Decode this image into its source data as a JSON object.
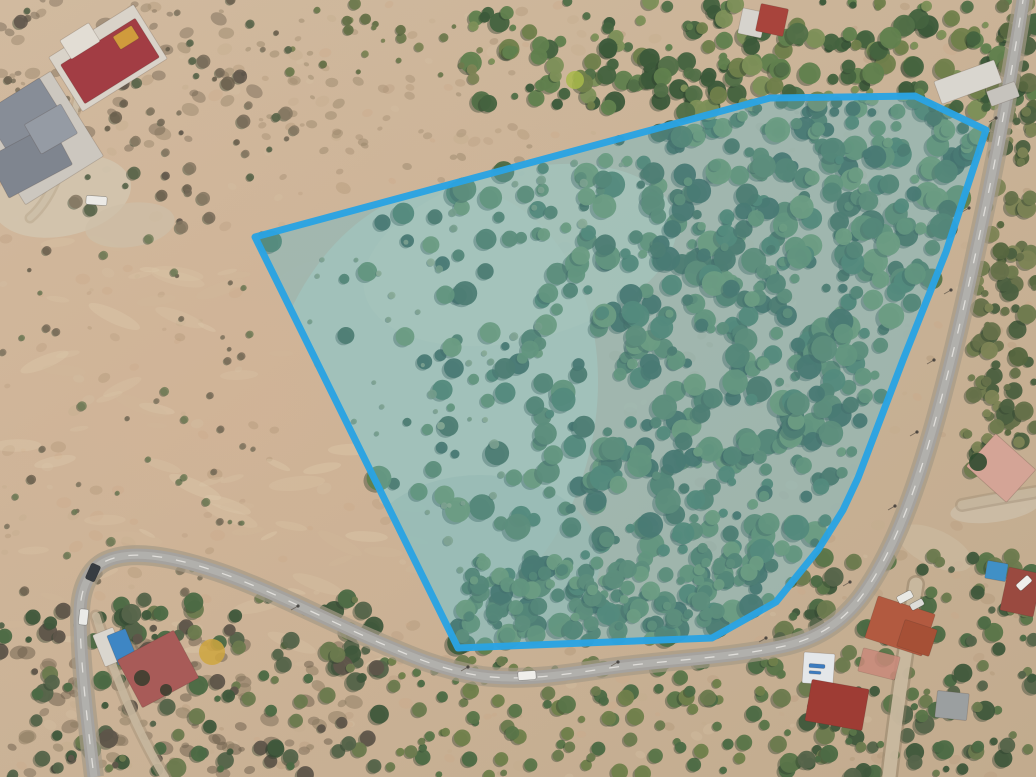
{
  "meta": {
    "image_type": "drone-aerial-orthophoto",
    "alt": "Aerial drone photo of a wooded land parcel outlined with a blue boundary, dry scrubland to the west, a paved road wrapping the south and east sides, and scattered houses"
  },
  "canvas": {
    "width": 1036,
    "height": 777
  },
  "scene": {
    "base_light": "#d1ba9f",
    "base_dark": "#c2ab8e",
    "pink_tint": "#d8b294",
    "tree_shadow": "#2c3f2e"
  },
  "parcel": {
    "name": "highlighted-land-parcel",
    "points": [
      [
        255,
        237
      ],
      [
        770,
        98
      ],
      [
        915,
        96
      ],
      [
        986,
        130
      ],
      [
        946,
        252
      ],
      [
        903,
        360
      ],
      [
        858,
        478
      ],
      [
        843,
        510
      ],
      [
        818,
        550
      ],
      [
        776,
        602
      ],
      [
        712,
        638
      ],
      [
        458,
        648
      ]
    ],
    "fill": "rgba(105,195,230,0.33)",
    "stroke": "#2aa3e2",
    "stroke_width": 7,
    "base_fill": "#a8b08e",
    "base_opacity": 0.45
  },
  "meadows": [
    {
      "name": "parcel-meadow-main",
      "cx": 430,
      "cy": 410,
      "rx": 165,
      "ry": 225,
      "rot": 12,
      "fill": "#bcc2a6",
      "opacity": 0.9
    },
    {
      "name": "parcel-meadow-upper",
      "cx": 520,
      "cy": 255,
      "rx": 160,
      "ry": 85,
      "rot": -14,
      "fill": "#c0c4a6",
      "opacity": 0.8
    },
    {
      "name": "parcel-meadow-lower",
      "cx": 480,
      "cy": 560,
      "rx": 120,
      "ry": 85,
      "rot": 0,
      "fill": "#aeb89c",
      "opacity": 0.7
    }
  ],
  "road": {
    "name": "paved-road",
    "path": "M 1024,-6 C 1014,58 1000,140 984,214 C 968,290 950,372 928,446 C 910,506 890,556 864,593 C 842,624 814,640 780,647 C 722,659 662,660 602,669 C 562,675 522,681 482,676 C 442,670 410,656 371,639 C 321,617 262,586 212,570 C 172,557 132,549 106,561 C 89,569 80,589 80,614 C 80,659 87,719 94,777",
    "casing": "#a59a86",
    "surface": "#a5a29e",
    "wear": "#c2c0bc",
    "line": "#eceae6",
    "width": 13
  },
  "dirt_roads": [
    {
      "name": "dirt-road-southeast",
      "path": "M 916,584 C 907,642 897,706 889,777",
      "stroke": "#c9b9a0",
      "edge": "#8a7a62",
      "width": 13,
      "opacity": 0.95
    },
    {
      "name": "trail-northwest",
      "path": "M 30,218 C 56,196 68,150 76,106 C 80,81 90,62 103,52",
      "stroke": "#cfc1aa",
      "edge": "#b3a188",
      "width": 6,
      "opacity": 0.85
    },
    {
      "name": "driveway-southwest",
      "path": "M 96,616 C 108,654 124,699 142,735 C 151,753 158,766 165,777",
      "stroke": "#c6b79e",
      "edge": "#a08f76",
      "width": 8,
      "opacity": 0.9
    },
    {
      "name": "driveway-east",
      "path": "M 962,505 C 988,500 1012,496 1036,492",
      "stroke": "#c6b79e",
      "edge": "#a08f76",
      "width": 9,
      "opacity": 0.9
    }
  ],
  "dirt_areas": [
    {
      "name": "clearing-northwest-driveway",
      "cx": 62,
      "cy": 196,
      "rx": 70,
      "ry": 40,
      "rot": -12,
      "fill": "#d2c4ae",
      "opacity": 0.9
    },
    {
      "name": "clearing-northwest-2",
      "cx": 130,
      "cy": 225,
      "rx": 45,
      "ry": 22,
      "rot": -8,
      "fill": "#cdbfa8",
      "opacity": 0.7
    },
    {
      "name": "dirt-patch-east-house",
      "cx": 995,
      "cy": 508,
      "rx": 45,
      "ry": 14,
      "rot": -8,
      "fill": "#cbbda6",
      "opacity": 0.9
    },
    {
      "name": "dirt-patch-southeast",
      "cx": 935,
      "cy": 548,
      "rx": 40,
      "ry": 18,
      "rot": 25,
      "fill": "#c9b89e",
      "opacity": 0.8
    }
  ],
  "speckle_zones": [
    {
      "name": "dry-brush-global",
      "rect": [
        0,
        0,
        1036,
        777
      ],
      "count": 430,
      "rmin": 2,
      "rmax": 7,
      "colors": [
        "#b89c7e",
        "#c4ab8d",
        "#ad9174",
        "#d4bfa2",
        "#caa98a"
      ],
      "opacity": 0.35
    },
    {
      "name": "light-grass-streaks-west",
      "rect": [
        0,
        240,
        430,
        430
      ],
      "count": 90,
      "rmin": 4,
      "rmax": 13,
      "colors": [
        "#d9c6a8",
        "#e0cfb2",
        "#d2bb9a"
      ],
      "opacity": 0.3,
      "flat": true
    },
    {
      "name": "dark-scrub-southwest",
      "rect": [
        0,
        640,
        360,
        137
      ],
      "count": 95,
      "rmin": 3,
      "rmax": 9,
      "colors": [
        "#7c6c58",
        "#6a5c4a",
        "#8a795f"
      ],
      "opacity": 0.5
    },
    {
      "name": "dark-scrub-northwest",
      "rect": [
        0,
        0,
        270,
        150
      ],
      "count": 65,
      "rmin": 2,
      "rmax": 8,
      "colors": [
        "#7c6c58",
        "#6f6150",
        "#948268"
      ],
      "opacity": 0.45
    },
    {
      "name": "scrub-north-middle",
      "rect": [
        260,
        20,
        280,
        160
      ],
      "count": 50,
      "rmin": 2,
      "rmax": 6,
      "colors": [
        "#a08a6e",
        "#8f7c62"
      ],
      "opacity": 0.4
    }
  ],
  "tree_regions": [
    {
      "name": "parcel-forest",
      "poly": [
        [
          255,
          237
        ],
        [
          770,
          98
        ],
        [
          915,
          96
        ],
        [
          986,
          130
        ],
        [
          946,
          252
        ],
        [
          903,
          360
        ],
        [
          858,
          478
        ],
        [
          843,
          510
        ],
        [
          818,
          550
        ],
        [
          776,
          602
        ],
        [
          712,
          638
        ],
        [
          458,
          648
        ]
      ],
      "count": 680,
      "rmin": 4,
      "rmax": 13,
      "colors": [
        "#3f5d3c",
        "#4a6a43",
        "#567549",
        "#5f7f4d",
        "#6d8a52",
        "#49704a",
        "#3a573d"
      ],
      "density": "east"
    },
    {
      "name": "parcel-forest-south",
      "poly": [
        [
          470,
          560
        ],
        [
          760,
          560
        ],
        [
          712,
          638
        ],
        [
          460,
          648
        ]
      ],
      "count": 100,
      "rmin": 4,
      "rmax": 10,
      "colors": [
        "#4a6a43",
        "#567549",
        "#5f7f4d",
        "#6d8a52"
      ]
    },
    {
      "name": "parcel-clearing-shrubs",
      "poly": [
        [
          270,
          250
        ],
        [
          640,
          140
        ],
        [
          560,
          300
        ],
        [
          500,
          500
        ],
        [
          462,
          620
        ],
        [
          380,
          470
        ],
        [
          310,
          340
        ]
      ],
      "count": 45,
      "rmin": 2,
      "rmax": 5,
      "colors": [
        "#8a9468",
        "#7d8d60",
        "#98a070"
      ],
      "opacity": 0.85
    },
    {
      "name": "tree-band-north",
      "rect": [
        470,
        0,
        566,
        112
      ],
      "count": 240,
      "rmin": 3,
      "rmax": 11,
      "colors": [
        "#44633f",
        "#527048",
        "#61814e",
        "#707f4b",
        "#7d9059",
        "#3c5a3a"
      ]
    },
    {
      "name": "tree-band-north-sparse",
      "rect": [
        280,
        0,
        200,
        80
      ],
      "count": 26,
      "rmin": 2,
      "rmax": 6,
      "colors": [
        "#6f7a4e",
        "#7d8455",
        "#667148"
      ]
    },
    {
      "name": "scrub-east-of-road",
      "poly": [
        [
          1000,
          0
        ],
        [
          1036,
          0
        ],
        [
          1036,
          470
        ],
        [
          952,
          470
        ],
        [
          966,
          360
        ],
        [
          986,
          210
        ]
      ],
      "count": 130,
      "rmin": 3,
      "rmax": 10,
      "colors": [
        "#6f7a4e",
        "#66714a",
        "#56663f",
        "#7d8455",
        "#4c6040"
      ]
    },
    {
      "name": "trees-southeast",
      "rect": [
        780,
        555,
        256,
        222
      ],
      "count": 150,
      "rmin": 3,
      "rmax": 10,
      "colors": [
        "#40583c",
        "#4c6a44",
        "#5a7549",
        "#6b7a4e",
        "#55644a"
      ]
    },
    {
      "name": "trees-south-center",
      "rect": [
        380,
        658,
        400,
        119
      ],
      "count": 110,
      "rmin": 3,
      "rmax": 9,
      "colors": [
        "#5a7549",
        "#6b7a4e",
        "#707f4b",
        "#4c6a44"
      ]
    },
    {
      "name": "trees-southwest",
      "rect": [
        0,
        598,
        380,
        179
      ],
      "count": 150,
      "rmin": 3,
      "rmax": 10,
      "colors": [
        "#4c6a44",
        "#55644a",
        "#6b7a4e",
        "#5f554a",
        "#40583c"
      ]
    },
    {
      "name": "shrubs-west-sparse",
      "rect": [
        0,
        235,
        255,
        360
      ],
      "count": 55,
      "rmin": 2,
      "rmax": 5,
      "colors": [
        "#776a58",
        "#6b5f4e",
        "#857762",
        "#6e7a55"
      ],
      "opacity": 0.8
    },
    {
      "name": "shrubs-northwest",
      "rect": [
        0,
        0,
        300,
        235
      ],
      "count": 70,
      "rmin": 2,
      "rmax": 7,
      "colors": [
        "#776a58",
        "#6b5f4e",
        "#857762",
        "#5f554a",
        "#566348"
      ],
      "opacity": 0.85
    }
  ],
  "poles": [
    [
      996,
      118
    ],
    [
      969,
      208
    ],
    [
      951,
      290
    ],
    [
      934,
      360
    ],
    [
      917,
      432
    ],
    [
      895,
      506
    ],
    [
      850,
      582
    ],
    [
      766,
      638
    ],
    [
      618,
      662
    ],
    [
      468,
      667
    ],
    [
      298,
      606
    ]
  ],
  "buildings": [
    {
      "name": "house-northwest-base",
      "x": 58,
      "y": 26,
      "w": 100,
      "h": 64,
      "rot": -32,
      "fill": "#d9d3c9"
    },
    {
      "name": "house-northwest-red-roof",
      "x": 66,
      "y": 38,
      "w": 88,
      "h": 46,
      "rot": -32,
      "fill": "#a23d44"
    },
    {
      "name": "house-northwest-terrace",
      "x": 63,
      "y": 30,
      "w": 34,
      "h": 22,
      "rot": -32,
      "fill": "#e2ddd4"
    },
    {
      "name": "house-northwest-amber-patch",
      "x": 115,
      "y": 30,
      "w": 22,
      "h": 15,
      "rot": -32,
      "fill": "#d09b3c"
    },
    {
      "name": "house-gray-base",
      "x": -8,
      "y": 88,
      "w": 92,
      "h": 100,
      "rot": -32,
      "fill": "#ccc7bf"
    },
    {
      "name": "house-gray-wing-a",
      "x": -10,
      "y": 92,
      "w": 66,
      "h": 44,
      "rot": -32,
      "fill": "#878d97"
    },
    {
      "name": "house-gray-wing-b",
      "x": -6,
      "y": 138,
      "w": 72,
      "h": 46,
      "rot": -28,
      "fill": "#7f858f"
    },
    {
      "name": "house-gray-wing-c",
      "x": 30,
      "y": 112,
      "w": 42,
      "h": 34,
      "rot": -30,
      "fill": "#959ba4"
    },
    {
      "name": "house-north-white",
      "x": 740,
      "y": 10,
      "w": 24,
      "h": 26,
      "rot": 12,
      "fill": "#d6d3cd"
    },
    {
      "name": "house-north-red",
      "x": 758,
      "y": 6,
      "w": 28,
      "h": 28,
      "rot": 12,
      "fill": "#a8443c"
    },
    {
      "name": "building-northeast-white",
      "x": 936,
      "y": 70,
      "w": 64,
      "h": 24,
      "rot": -20,
      "fill": "#d9d6cf"
    },
    {
      "name": "building-northeast-white-2",
      "x": 988,
      "y": 86,
      "w": 30,
      "h": 16,
      "rot": -20,
      "fill": "#c6c3bd"
    },
    {
      "name": "house-east-pink-roof",
      "x": 974,
      "y": 446,
      "w": 54,
      "h": 44,
      "rot": 42,
      "fill": "#d4a496"
    },
    {
      "name": "pool-east-house",
      "x": 986,
      "y": 562,
      "w": 21,
      "h": 18,
      "rot": 10,
      "fill": "#4090c6"
    },
    {
      "name": "house-east-pool-roof",
      "x": 1004,
      "y": 570,
      "w": 34,
      "h": 44,
      "rot": 12,
      "fill": "#9a4a40"
    },
    {
      "name": "house-terracotta-main",
      "x": 870,
      "y": 604,
      "w": 60,
      "h": 44,
      "rot": 18,
      "fill": "#b25a40"
    },
    {
      "name": "house-terracotta-wing",
      "x": 900,
      "y": 624,
      "w": 34,
      "h": 28,
      "rot": 18,
      "fill": "#a65036"
    },
    {
      "name": "courtyard-pink",
      "x": 860,
      "y": 652,
      "w": 38,
      "h": 24,
      "rot": 14,
      "fill": "#c9897a",
      "opacity": 0.85
    },
    {
      "name": "building-white-shop",
      "x": 803,
      "y": 653,
      "w": 31,
      "h": 31,
      "rot": 4,
      "fill": "#e4e7e9"
    },
    {
      "name": "shop-blue-sign-mark",
      "x": 809,
      "y": 664,
      "w": 16,
      "h": 4,
      "rot": 4,
      "fill": "#3b7cc0"
    },
    {
      "name": "shop-blue-sign-mark-2",
      "x": 809,
      "y": 671,
      "w": 12,
      "h": 3,
      "rot": 4,
      "fill": "#3b7cc0"
    },
    {
      "name": "house-southeast-red",
      "x": 808,
      "y": 684,
      "w": 58,
      "h": 42,
      "rot": 10,
      "fill": "#9e3c34"
    },
    {
      "name": "shack-gray-southeast",
      "x": 936,
      "y": 692,
      "w": 32,
      "h": 27,
      "rot": 6,
      "fill": "#9b9fa0"
    },
    {
      "name": "deck-white-southwest",
      "x": 98,
      "y": 630,
      "w": 22,
      "h": 34,
      "rot": -22,
      "fill": "#dad6ce"
    },
    {
      "name": "pool-southwest-house",
      "x": 112,
      "y": 631,
      "w": 20,
      "h": 32,
      "rot": -22,
      "fill": "#3e86c4"
    },
    {
      "name": "house-southwest-red-roof",
      "x": 126,
      "y": 642,
      "w": 64,
      "h": 54,
      "rot": -28,
      "fill": "#a85b58"
    }
  ],
  "accent_trees": [
    {
      "name": "palm-shadow-on-roof",
      "x": 142,
      "y": 678,
      "r": 8,
      "fill": "#2e3b2a",
      "opacity": 0.8
    },
    {
      "name": "palm-shadow-on-roof-2",
      "x": 166,
      "y": 690,
      "r": 6,
      "fill": "#2e3b2a",
      "opacity": 0.8
    },
    {
      "name": "golden-tree-southwest",
      "x": 212,
      "y": 652,
      "r": 13,
      "fill": "#cfa63f",
      "opacity": 0.85
    },
    {
      "name": "yellow-shrub-north",
      "x": 575,
      "y": 80,
      "r": 9,
      "fill": "#a8b84a",
      "opacity": 0.85
    },
    {
      "name": "yellow-shrub-north-2",
      "x": 838,
      "y": 222,
      "r": 0,
      "fill": "#a8b84a",
      "opacity": 0
    },
    {
      "name": "palm-east-house",
      "x": 978,
      "y": 462,
      "r": 9,
      "fill": "#2f4a2f",
      "opacity": 0.9
    }
  ],
  "vehicles": [
    {
      "name": "van-white-northwest-driveway",
      "x": 86,
      "y": 196,
      "w": 21,
      "h": 9,
      "rot": 4,
      "fill": "#eceae6"
    },
    {
      "name": "car-dark-road-west",
      "x": 88,
      "y": 564,
      "w": 10,
      "h": 17,
      "rot": 24,
      "fill": "#373c42"
    },
    {
      "name": "car-white-road-west",
      "x": 79,
      "y": 609,
      "w": 9,
      "h": 16,
      "rot": 6,
      "fill": "#eaeae7"
    },
    {
      "name": "car-white-road-south",
      "x": 518,
      "y": 671,
      "w": 18,
      "h": 9,
      "rot": -4,
      "fill": "#efeeea"
    },
    {
      "name": "car-white-southeast-driveway",
      "x": 897,
      "y": 593,
      "w": 16,
      "h": 8,
      "rot": -28,
      "fill": "#e9e9e5"
    },
    {
      "name": "car-white-southeast-driveway-2",
      "x": 910,
      "y": 601,
      "w": 14,
      "h": 7,
      "rot": -28,
      "fill": "#dddcd8"
    },
    {
      "name": "car-white-east-pool-house",
      "x": 1016,
      "y": 579,
      "w": 16,
      "h": 8,
      "rot": -42,
      "fill": "#f0efeb"
    }
  ]
}
